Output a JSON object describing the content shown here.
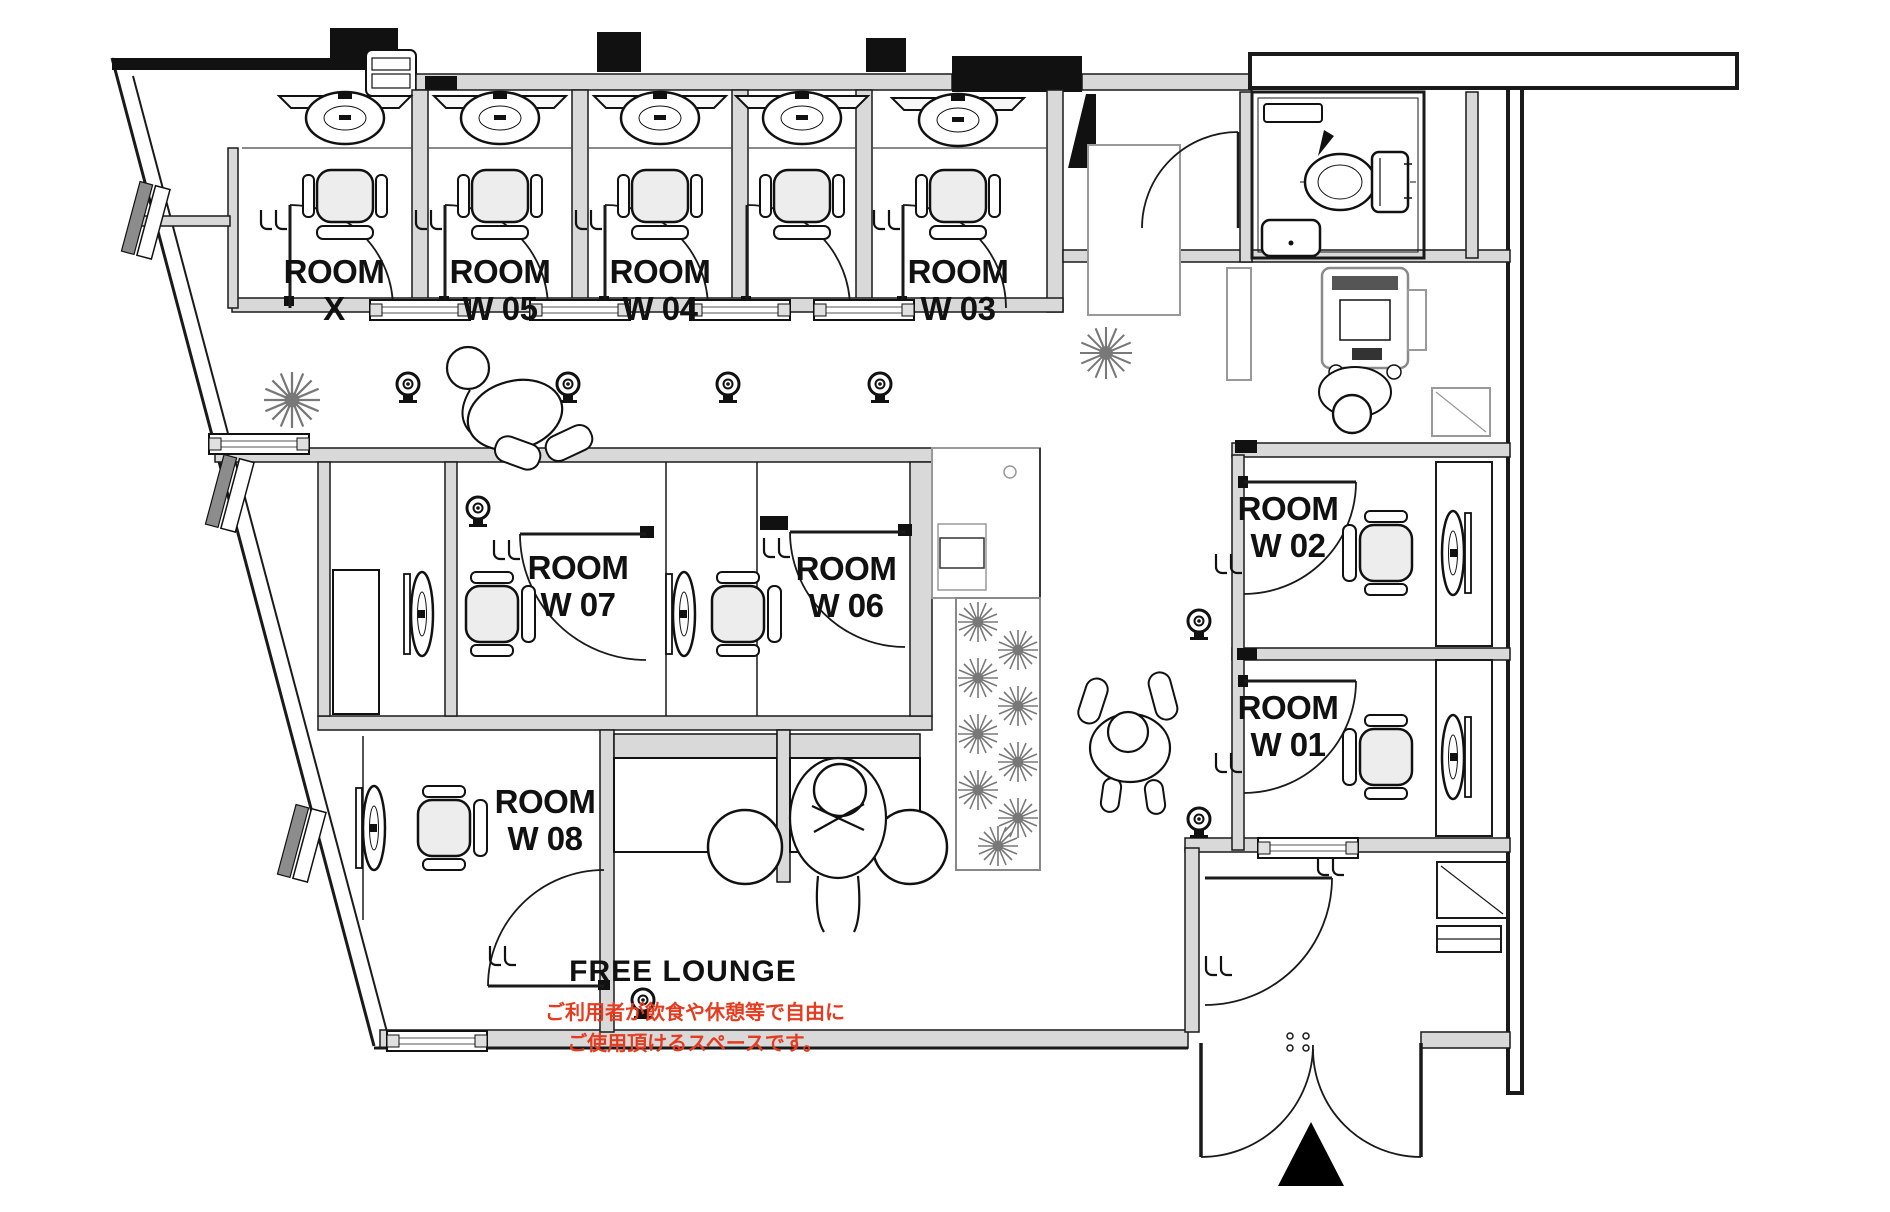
{
  "plan": {
    "rooms": [
      {
        "id": "x",
        "line1": "ROOM",
        "line2": "X"
      },
      {
        "id": "w05",
        "line1": "ROOM",
        "line2": "W 05"
      },
      {
        "id": "w04",
        "line1": "ROOM",
        "line2": "W 04"
      },
      {
        "id": "w03",
        "line1": "ROOM",
        "line2": "W 03"
      },
      {
        "id": "w02",
        "line1": "ROOM",
        "line2": "W 02"
      },
      {
        "id": "w01",
        "line1": "ROOM",
        "line2": "W 01"
      },
      {
        "id": "w07",
        "line1": "ROOM",
        "line2": "W 07"
      },
      {
        "id": "w06",
        "line1": "ROOM",
        "line2": "W 06"
      },
      {
        "id": "w08",
        "line1": "ROOM",
        "line2": "W 08"
      }
    ],
    "lounge": {
      "title": "FREE LOUNGE",
      "note_line1": "ご利用者が飲食や休憩等で自由に",
      "note_line2": "ご使用頂けるスペースです。",
      "note_color": "#e53c20"
    },
    "colors": {
      "line": "#1a1a1a",
      "wall_fill": "#d9d9d9",
      "note_red": "#e53c20"
    },
    "symbols": [
      "entrance-triangle",
      "security-camera",
      "plant",
      "toilet",
      "sink",
      "office-chair",
      "desk-monitor",
      "round-stool",
      "door-swing",
      "person",
      "copier",
      "threshold-rail"
    ]
  }
}
